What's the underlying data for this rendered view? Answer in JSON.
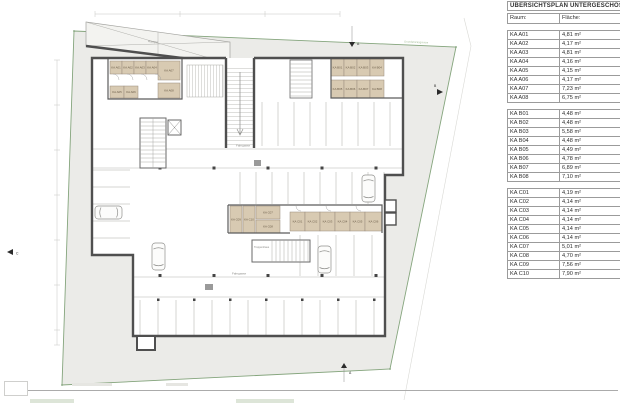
{
  "table": {
    "title": "ÜBERSICHTSPLAN UNTERGESCHOSS",
    "columns": {
      "room": "Raum:",
      "area": "Fläche:"
    },
    "groups": [
      {
        "name": "A",
        "rows": [
          {
            "room": "KA A01",
            "area": "4,81 m²"
          },
          {
            "room": "KA A02",
            "area": "4,17 m²"
          },
          {
            "room": "KA A03",
            "area": "4,81 m²"
          },
          {
            "room": "KA A04",
            "area": "4,16 m²"
          },
          {
            "room": "KA A05",
            "area": "4,15 m²"
          },
          {
            "room": "KA A06",
            "area": "4,17 m²"
          },
          {
            "room": "KA A07",
            "area": "7,23 m²"
          },
          {
            "room": "KA A08",
            "area": "6,75 m²"
          }
        ]
      },
      {
        "name": "B",
        "rows": [
          {
            "room": "KA B01",
            "area": "4,48 m²"
          },
          {
            "room": "KA B02",
            "area": "4,48 m²"
          },
          {
            "room": "KA B03",
            "area": "5,58 m²"
          },
          {
            "room": "KA B04",
            "area": "4,48 m²"
          },
          {
            "room": "KA B05",
            "area": "4,49 m²"
          },
          {
            "room": "KA B06",
            "area": "4,78 m²"
          },
          {
            "room": "KA B07",
            "area": "6,89 m²"
          },
          {
            "room": "KA B08",
            "area": "7,10 m²"
          }
        ]
      },
      {
        "name": "C",
        "rows": [
          {
            "room": "KA C01",
            "area": "4,19 m²"
          },
          {
            "room": "KA C02",
            "area": "4,14 m²"
          },
          {
            "room": "KA C03",
            "area": "4,14 m²"
          },
          {
            "room": "KA C04",
            "area": "4,14 m²"
          },
          {
            "room": "KA C05",
            "area": "4,14 m²"
          },
          {
            "room": "KA C06",
            "area": "4,14 m²"
          },
          {
            "room": "KA C07",
            "area": "5,01 m²"
          },
          {
            "room": "KA C08",
            "area": "4,70 m²"
          },
          {
            "room": "KA C09",
            "area": "7,56 m²"
          },
          {
            "room": "KA C10",
            "area": "7,90 m²"
          }
        ]
      }
    ]
  },
  "plan": {
    "boundary_label": "Grundstücksgrenze",
    "ramp_label": "Rampe",
    "lane_label": "Fahrgasse",
    "stair_label": "Treppenhaus",
    "markers": {
      "top": "A",
      "bottom": "A",
      "right": "B",
      "left": "C"
    },
    "rooms": {
      "A": [
        "KA A01",
        "KA A02",
        "KA A03",
        "KA A04",
        "KA A05",
        "KA A06",
        "KA A07",
        "KA A08"
      ],
      "B": [
        "KA B01",
        "KA B02",
        "KA B03",
        "KA B04",
        "KA B05",
        "KA B06",
        "KA B07",
        "KA B08"
      ],
      "C": [
        "KA C01",
        "KA C02",
        "KA C03",
        "KA C04",
        "KA C05",
        "KA C06",
        "KA C07",
        "KA C08",
        "KA C09",
        "KA C10"
      ]
    }
  }
}
